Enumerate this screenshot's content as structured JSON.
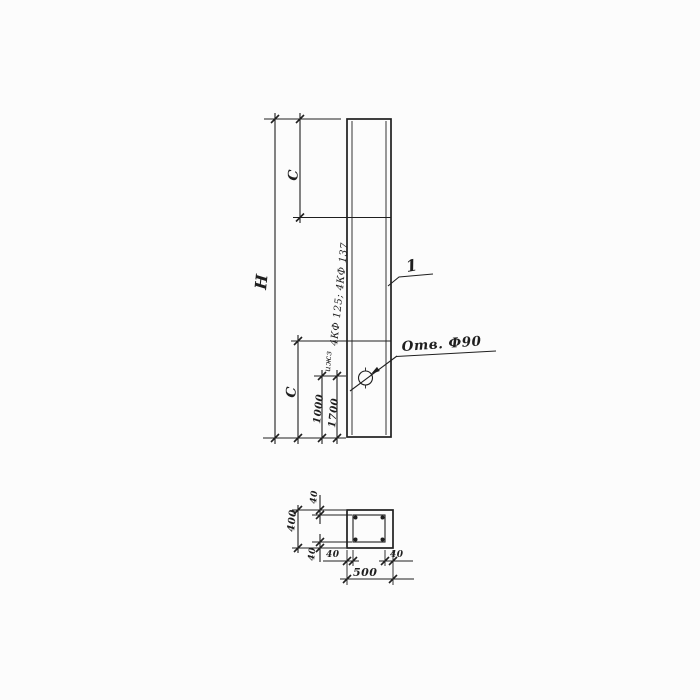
{
  "ink": "#1f1f1f",
  "paper": "#fcfcfc",
  "elevation": {
    "dim_height_total": "H",
    "dim_c_top": "C",
    "dim_c_bottom": "C",
    "dim_1000": "1000",
    "dim_1700": "1700",
    "mark_note": "4КФ 125; 4КФ 137",
    "small_note": "ижз",
    "hole_label": "Отв. Ф90",
    "position_label": "1"
  },
  "section": {
    "dim_total_width": "500",
    "dim_total_height": "400",
    "cover_top": "40",
    "cover_bottom": "40",
    "cover_left": "40",
    "cover_right": "40"
  }
}
